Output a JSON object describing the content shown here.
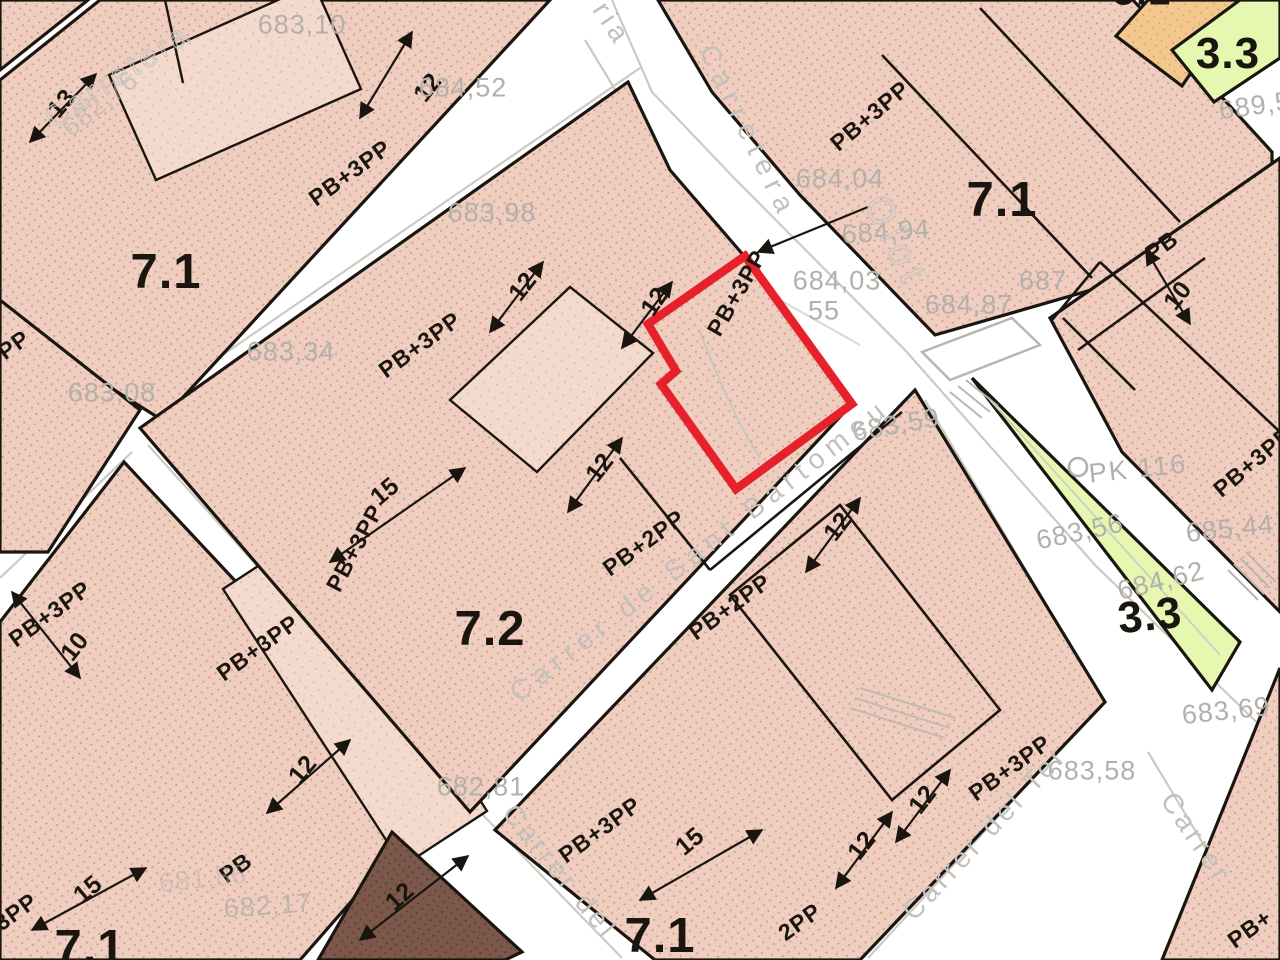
{
  "map_type": "urban planning / cadastral zoning map",
  "highlighted_parcel": {
    "label": "PB+3PP",
    "outline_color": "#e7212b"
  },
  "colors": {
    "block_fill": "#f0cebf",
    "block_dots": "#a06e5d",
    "building_fill": "#f4dacd",
    "dark_block": "#7b584a",
    "orange_block": "#f4c78e",
    "green_zone": "#e6f7af",
    "line": "#1b1510",
    "gray_text": "#b3b0ac",
    "red": "#e7212b"
  },
  "labels": [
    {
      "name": "zone-7-1-topleft",
      "kind": "zone",
      "text": "7.1",
      "x": 166,
      "y": 272,
      "rot": 0
    },
    {
      "name": "zone-7-1-topright",
      "kind": "zone",
      "text": "7.1",
      "x": 1002,
      "y": 200,
      "rot": 0
    },
    {
      "name": "zone-7-2-center",
      "kind": "zone",
      "text": "7.2",
      "x": 490,
      "y": 629,
      "rot": 0
    },
    {
      "name": "zone-7-1-bottomcenter",
      "kind": "zone",
      "text": "7.1",
      "x": 660,
      "y": 936,
      "rot": 0
    },
    {
      "name": "zone-7-1-bottomleft",
      "kind": "zone",
      "text": "7.1",
      "x": 90,
      "y": 948,
      "rot": 0
    },
    {
      "name": "zone-3-3-topright",
      "kind": "zone",
      "text": "3.3",
      "x": 1228,
      "y": 54,
      "rot": 0,
      "size": 44
    },
    {
      "name": "zone-3-3-median",
      "kind": "zone",
      "text": "3.3",
      "x": 1150,
      "y": 616,
      "rot": -6,
      "size": 44
    },
    {
      "name": "zone-cut-topedge",
      "kind": "zone",
      "text": "5.1",
      "x": 1142,
      "y": -8,
      "rot": 0,
      "size": 40
    },
    {
      "name": "code-pb3pp",
      "kind": "code",
      "text": "PB+3PP",
      "x": 350,
      "y": 173,
      "rot": -36
    },
    {
      "name": "code-pb3pp",
      "kind": "code",
      "text": "PB+3PP",
      "x": 420,
      "y": 345,
      "rot": -36
    },
    {
      "name": "code-pb3pp",
      "kind": "code",
      "text": "PB+3PP",
      "x": 870,
      "y": 116,
      "rot": -40
    },
    {
      "name": "code-pb3pp-red-parcel",
      "kind": "code",
      "text": "PB+3PP",
      "x": 737,
      "y": 293,
      "rot": -60
    },
    {
      "name": "code-pb2pp",
      "kind": "code",
      "text": "PB+2PP",
      "x": 644,
      "y": 543,
      "rot": -36
    },
    {
      "name": "code-pb3pp",
      "kind": "code",
      "text": "PB+3PP",
      "x": 355,
      "y": 548,
      "rot": -62
    },
    {
      "name": "code-pp-fragment",
      "kind": "code",
      "text": "PP",
      "x": 14,
      "y": 345,
      "rot": -36
    },
    {
      "name": "code-pb2pp",
      "kind": "code",
      "text": "PB+2PP",
      "x": 730,
      "y": 607,
      "rot": -36
    },
    {
      "name": "code-pb",
      "kind": "code",
      "text": "PB",
      "x": 1162,
      "y": 246,
      "rot": -36
    },
    {
      "name": "code-pb3pp",
      "kind": "code",
      "text": "PB+3PP",
      "x": 1253,
      "y": 462,
      "rot": -40
    },
    {
      "name": "code-pb3pp",
      "kind": "code",
      "text": "PB+3PP",
      "x": 50,
      "y": 614,
      "rot": -36
    },
    {
      "name": "code-pb3pp",
      "kind": "code",
      "text": "PB+3PP",
      "x": 258,
      "y": 648,
      "rot": -36
    },
    {
      "name": "code-pb",
      "kind": "code",
      "text": "PB",
      "x": 236,
      "y": 868,
      "rot": -36
    },
    {
      "name": "code-3pp-fragment",
      "kind": "code",
      "text": "3PP",
      "x": 16,
      "y": 912,
      "rot": -36
    },
    {
      "name": "code-pb3pp",
      "kind": "code",
      "text": "PB+3PP",
      "x": 600,
      "y": 830,
      "rot": -36
    },
    {
      "name": "code-pb3pp",
      "kind": "code",
      "text": "PB+3PP",
      "x": 1010,
      "y": 768,
      "rot": -36
    },
    {
      "name": "code-2pp-fragment",
      "kind": "code",
      "text": "2PP",
      "x": 800,
      "y": 922,
      "rot": -36
    },
    {
      "name": "code-pb-fragment",
      "kind": "code",
      "text": "PB+",
      "x": 1250,
      "y": 929,
      "rot": -36
    },
    {
      "name": "dim-13",
      "kind": "dim",
      "text": "13",
      "x": 62,
      "y": 104,
      "rot": -50
    },
    {
      "name": "dim-12",
      "kind": "dim",
      "text": "12",
      "x": 428,
      "y": 88,
      "rot": -52
    },
    {
      "name": "dim-12",
      "kind": "dim",
      "text": "12",
      "x": 523,
      "y": 287,
      "rot": -52
    },
    {
      "name": "dim-15",
      "kind": "dim",
      "text": "15",
      "x": 385,
      "y": 492,
      "rot": -40
    },
    {
      "name": "dim-12",
      "kind": "dim",
      "text": "12",
      "x": 600,
      "y": 468,
      "rot": -52
    },
    {
      "name": "dim-12",
      "kind": "dim",
      "text": "12",
      "x": 655,
      "y": 302,
      "rot": -55
    },
    {
      "name": "dim-12",
      "kind": "dim",
      "text": "12",
      "x": 838,
      "y": 527,
      "rot": -52
    },
    {
      "name": "dim-10",
      "kind": "dim",
      "text": "10",
      "x": 1178,
      "y": 296,
      "rot": -52
    },
    {
      "name": "dim-12",
      "kind": "dim",
      "text": "12",
      "x": 303,
      "y": 770,
      "rot": -50
    },
    {
      "name": "dim-10",
      "kind": "dim",
      "text": "10",
      "x": 75,
      "y": 647,
      "rot": -52
    },
    {
      "name": "dim-15",
      "kind": "dim",
      "text": "15",
      "x": 88,
      "y": 890,
      "rot": -40
    },
    {
      "name": "dim-15",
      "kind": "dim",
      "text": "15",
      "x": 690,
      "y": 842,
      "rot": -40
    },
    {
      "name": "dim-12",
      "kind": "dim",
      "text": "12",
      "x": 862,
      "y": 846,
      "rot": -52
    },
    {
      "name": "dim-12",
      "kind": "dim",
      "text": "12",
      "x": 923,
      "y": 800,
      "rot": -52
    },
    {
      "name": "dim-12",
      "kind": "dim",
      "text": "12",
      "x": 400,
      "y": 897,
      "rot": -42
    },
    {
      "name": "elevation",
      "kind": "elev",
      "text": "683,10",
      "x": 302,
      "y": 25,
      "rot": 0
    },
    {
      "name": "elevation",
      "kind": "elev",
      "text": "682,76",
      "x": 100,
      "y": 104,
      "rot": -38,
      "op": 0.55
    },
    {
      "name": "elevation",
      "kind": "elev",
      "text": "684,52",
      "x": 463,
      "y": 88,
      "rot": 0
    },
    {
      "name": "elevation",
      "kind": "elev",
      "text": "683,98",
      "x": 492,
      "y": 213,
      "rot": 0
    },
    {
      "name": "elevation",
      "kind": "elev",
      "text": "683,34",
      "x": 291,
      "y": 352,
      "rot": 0
    },
    {
      "name": "elevation",
      "kind": "elev",
      "text": "683,08",
      "x": 112,
      "y": 393,
      "rot": 0
    },
    {
      "name": "elevation",
      "kind": "elev",
      "text": "684,04",
      "x": 840,
      "y": 179,
      "rot": 0
    },
    {
      "name": "elevation",
      "kind": "elev",
      "text": "684,94",
      "x": 886,
      "y": 232,
      "rot": -4
    },
    {
      "name": "elevation",
      "kind": "elev",
      "text": "684,03",
      "x": 837,
      "y": 281,
      "rot": 0
    },
    {
      "name": "elevation",
      "kind": "elev",
      "text": "55",
      "x": 824,
      "y": 311,
      "rot": 0
    },
    {
      "name": "elevation",
      "kind": "elev",
      "text": "684,87",
      "x": 969,
      "y": 305,
      "rot": 0
    },
    {
      "name": "elevation",
      "kind": "elev",
      "text": "687",
      "x": 1043,
      "y": 281,
      "rot": 0
    },
    {
      "name": "elevation",
      "kind": "elev",
      "text": "683,59",
      "x": 896,
      "y": 425,
      "rot": -10
    },
    {
      "name": "elevation",
      "kind": "elev",
      "text": "689,5",
      "x": 1255,
      "y": 106,
      "rot": -8
    },
    {
      "name": "elevation",
      "kind": "elev",
      "text": "683,56",
      "x": 1080,
      "y": 532,
      "rot": -12
    },
    {
      "name": "elevation",
      "kind": "elev",
      "text": "685,44",
      "x": 1230,
      "y": 529,
      "rot": -6
    },
    {
      "name": "elevation",
      "kind": "elev",
      "text": "684,62",
      "x": 1161,
      "y": 581,
      "rot": -14
    },
    {
      "name": "elevation",
      "kind": "elev",
      "text": "683,69",
      "x": 1226,
      "y": 711,
      "rot": -6
    },
    {
      "name": "elevation",
      "kind": "elev",
      "text": "683,58",
      "x": 1092,
      "y": 771,
      "rot": 0
    },
    {
      "name": "elevation",
      "kind": "elev",
      "text": "682,81",
      "x": 481,
      "y": 787,
      "rot": 0
    },
    {
      "name": "elevation",
      "kind": "elev",
      "text": "681,86",
      "x": 203,
      "y": 879,
      "rot": -6,
      "op": 0.45
    },
    {
      "name": "elevation",
      "kind": "elev",
      "text": "682,17",
      "x": 268,
      "y": 906,
      "rot": -4,
      "op": 0.8
    },
    {
      "name": "street-name-carretera",
      "kind": "street",
      "text": "Carretera",
      "x": 748,
      "y": 132,
      "rot": 64,
      "ls": 8
    },
    {
      "name": "street-name-olot",
      "kind": "street-outline",
      "text": "Olot",
      "x": 895,
      "y": 242,
      "rot": 64,
      "ls": 7,
      "size": 38
    },
    {
      "name": "street-name-fragment-ria",
      "kind": "street",
      "text": "ria",
      "x": 612,
      "y": 24,
      "rot": 56
    },
    {
      "name": "street-name-carretera-outline",
      "kind": "street-outline",
      "text": "Carretera",
      "x": 118,
      "y": 76,
      "rot": -33,
      "op": 0.85
    },
    {
      "name": "street-name-sant-bartomeu",
      "kind": "street",
      "text": "Carrer de Sant Bartomeu",
      "x": 700,
      "y": 550,
      "rot": -38,
      "ls": 7
    },
    {
      "name": "street-name-carrer-del",
      "kind": "street",
      "text": "Carrer del",
      "x": 560,
      "y": 872,
      "rot": 51,
      "ls": 4
    },
    {
      "name": "street-name-carrer-del-ter",
      "kind": "street",
      "text": "Carrer del Ter",
      "x": 985,
      "y": 833,
      "rot": -47,
      "ls": 4
    },
    {
      "name": "street-name-carrer",
      "kind": "street",
      "text": "Carrer",
      "x": 1196,
      "y": 838,
      "rot": 56,
      "ls": 4
    },
    {
      "name": "km-post-label",
      "kind": "marker",
      "text": "PK 116",
      "x": 1138,
      "y": 469,
      "rot": -6
    }
  ]
}
